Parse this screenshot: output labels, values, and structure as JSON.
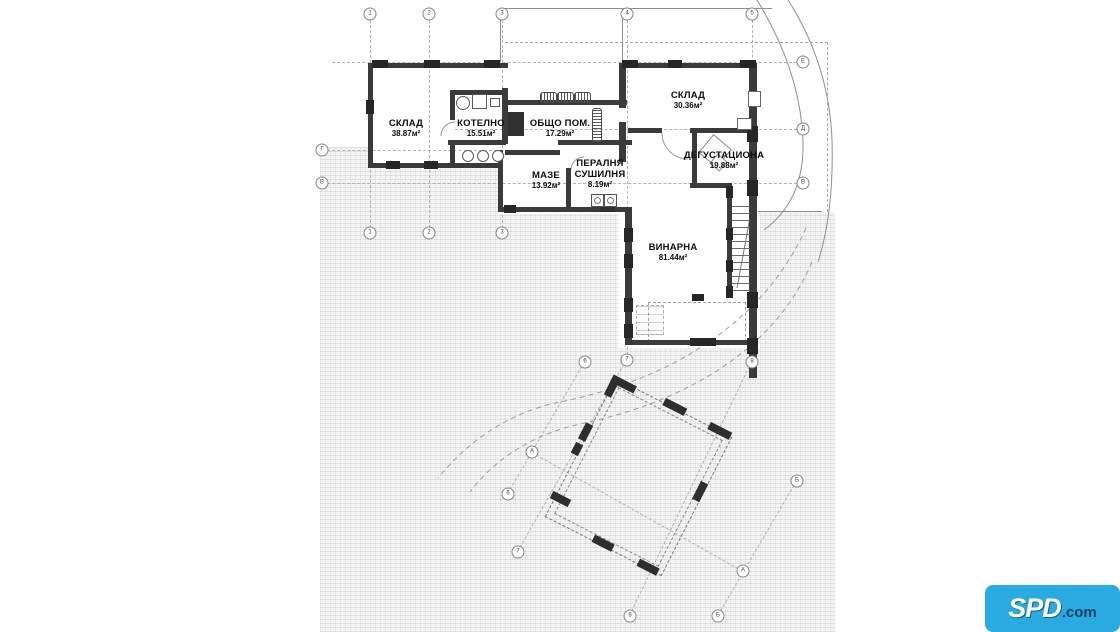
{
  "plan": {
    "rooms": [
      {
        "name": "СКЛАД",
        "area": "38.87м²"
      },
      {
        "name": "КОТЕЛНО",
        "area": "15.51м²"
      },
      {
        "name": "ОБЩО ПОМ.",
        "area": "17.29м²"
      },
      {
        "name": "СКЛАД",
        "area": "30.36м²"
      },
      {
        "name": "ДЕГУСТАЦИОНА",
        "area": "19.88м²"
      },
      {
        "name": "МАЗЕ",
        "area": "13.92м²"
      },
      {
        "name": "ПЕРАЛНЯ",
        "name2": "СУШИЛНЯ",
        "area": "8.19м²"
      },
      {
        "name": "ВИНАРНА",
        "area": "81.44м²"
      }
    ]
  },
  "axes": {
    "bubbles": [
      "1",
      "2",
      "3",
      "4",
      "5",
      "1",
      "2",
      "3",
      "Е",
      "Д",
      "В",
      "Г",
      "В",
      "6",
      "7",
      "8",
      "6",
      "7",
      "8",
      "А",
      "А",
      "Б",
      "Б"
    ]
  },
  "logo": {
    "brand": "SPD",
    "suffix": ".com"
  },
  "colors": {
    "logo_cyan": "#29abe2",
    "wall": "#3a3a3a",
    "hatch_base": "#f4f4f4"
  }
}
